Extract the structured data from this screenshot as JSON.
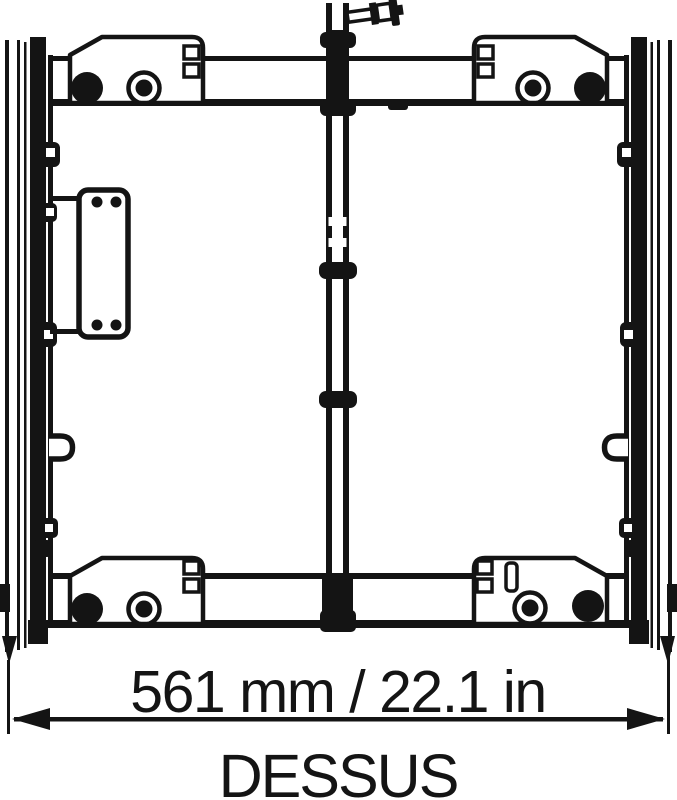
{
  "drawing": {
    "view_label": "DESSUS",
    "dimension_label": "561 mm / 22.1 in",
    "dimension_mm": 561,
    "dimension_in": 22.1,
    "line_color": "#141414",
    "background_color": "#ffffff"
  }
}
